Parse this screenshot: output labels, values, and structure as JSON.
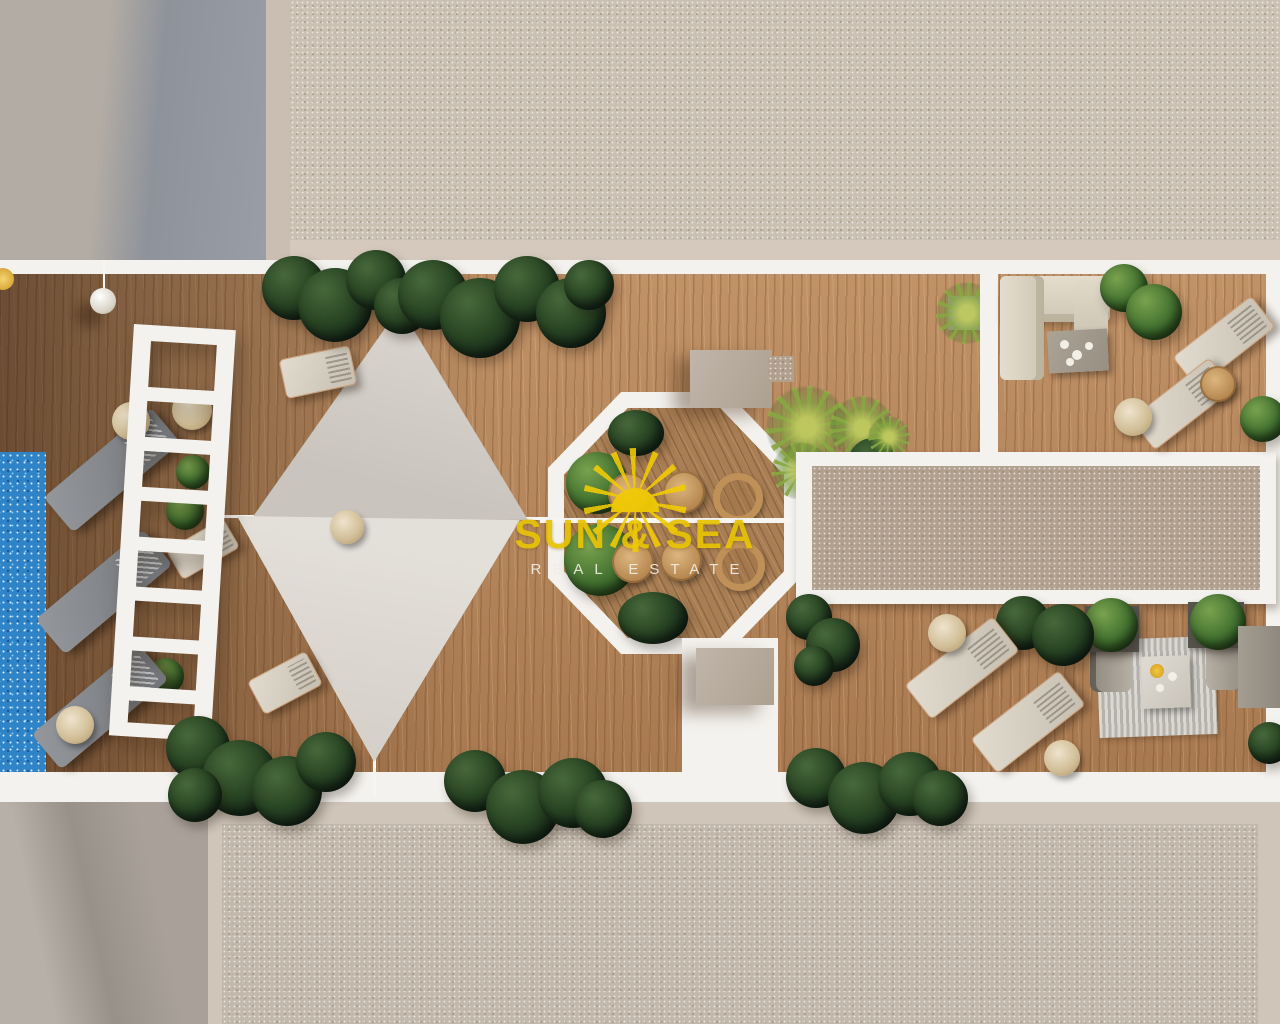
{
  "watermark": {
    "brand": "SUN & SEA",
    "tagline": "REAL ESTATE"
  },
  "scene": {
    "type": "aerial-3d-render",
    "subject": "rooftop terrace of a residential building with swimming pool, wooden deck, sun loungers, white pergola, triangular shade sails, octagonal dining patio, lounge sofa area and gravel roof sections",
    "colors": {
      "pool_blue": "#2f84c8",
      "deck_wood": "#b5855a",
      "octagon_wood": "#a87e54",
      "white_trim": "#f4f2ee",
      "gravel_light": "#cbc1b3",
      "gravel_brown": "#b2a08e",
      "roof_gray": "#b3aca4",
      "roof_shadow_gray": "#8e939b",
      "sail_gray": "#d8d4cd",
      "plant_dark": "#233c1f",
      "plant_light": "#7da23f",
      "cream_furniture": "#ded7c7",
      "lounger_gray": "#84878c",
      "watermark_yellow": "#e7c306",
      "watermark_white": "#f2ede2"
    }
  }
}
